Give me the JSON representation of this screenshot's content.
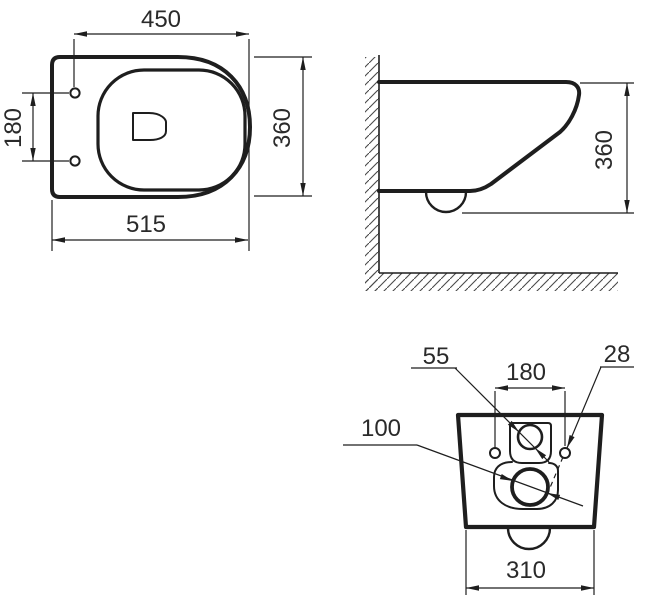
{
  "title": "Wall-hung toilet dimensional drawing",
  "colors": {
    "line": "#1e1e1e",
    "text": "#2a2a2a",
    "hatch": "#4a4a4a",
    "background": "#ffffff"
  },
  "views": {
    "plan": {
      "name": "top-view",
      "dims": {
        "front_to_holes": "450",
        "hole_spacing": "180",
        "total_depth": "515",
        "width": "360"
      }
    },
    "side": {
      "name": "side-view",
      "dims": {
        "height": "360"
      }
    },
    "rear": {
      "name": "rear-view",
      "dims": {
        "inlet_dia": "55",
        "hole_spacing": "180",
        "hole_dia": "28",
        "outlet_dia": "100",
        "width": "310"
      }
    }
  }
}
